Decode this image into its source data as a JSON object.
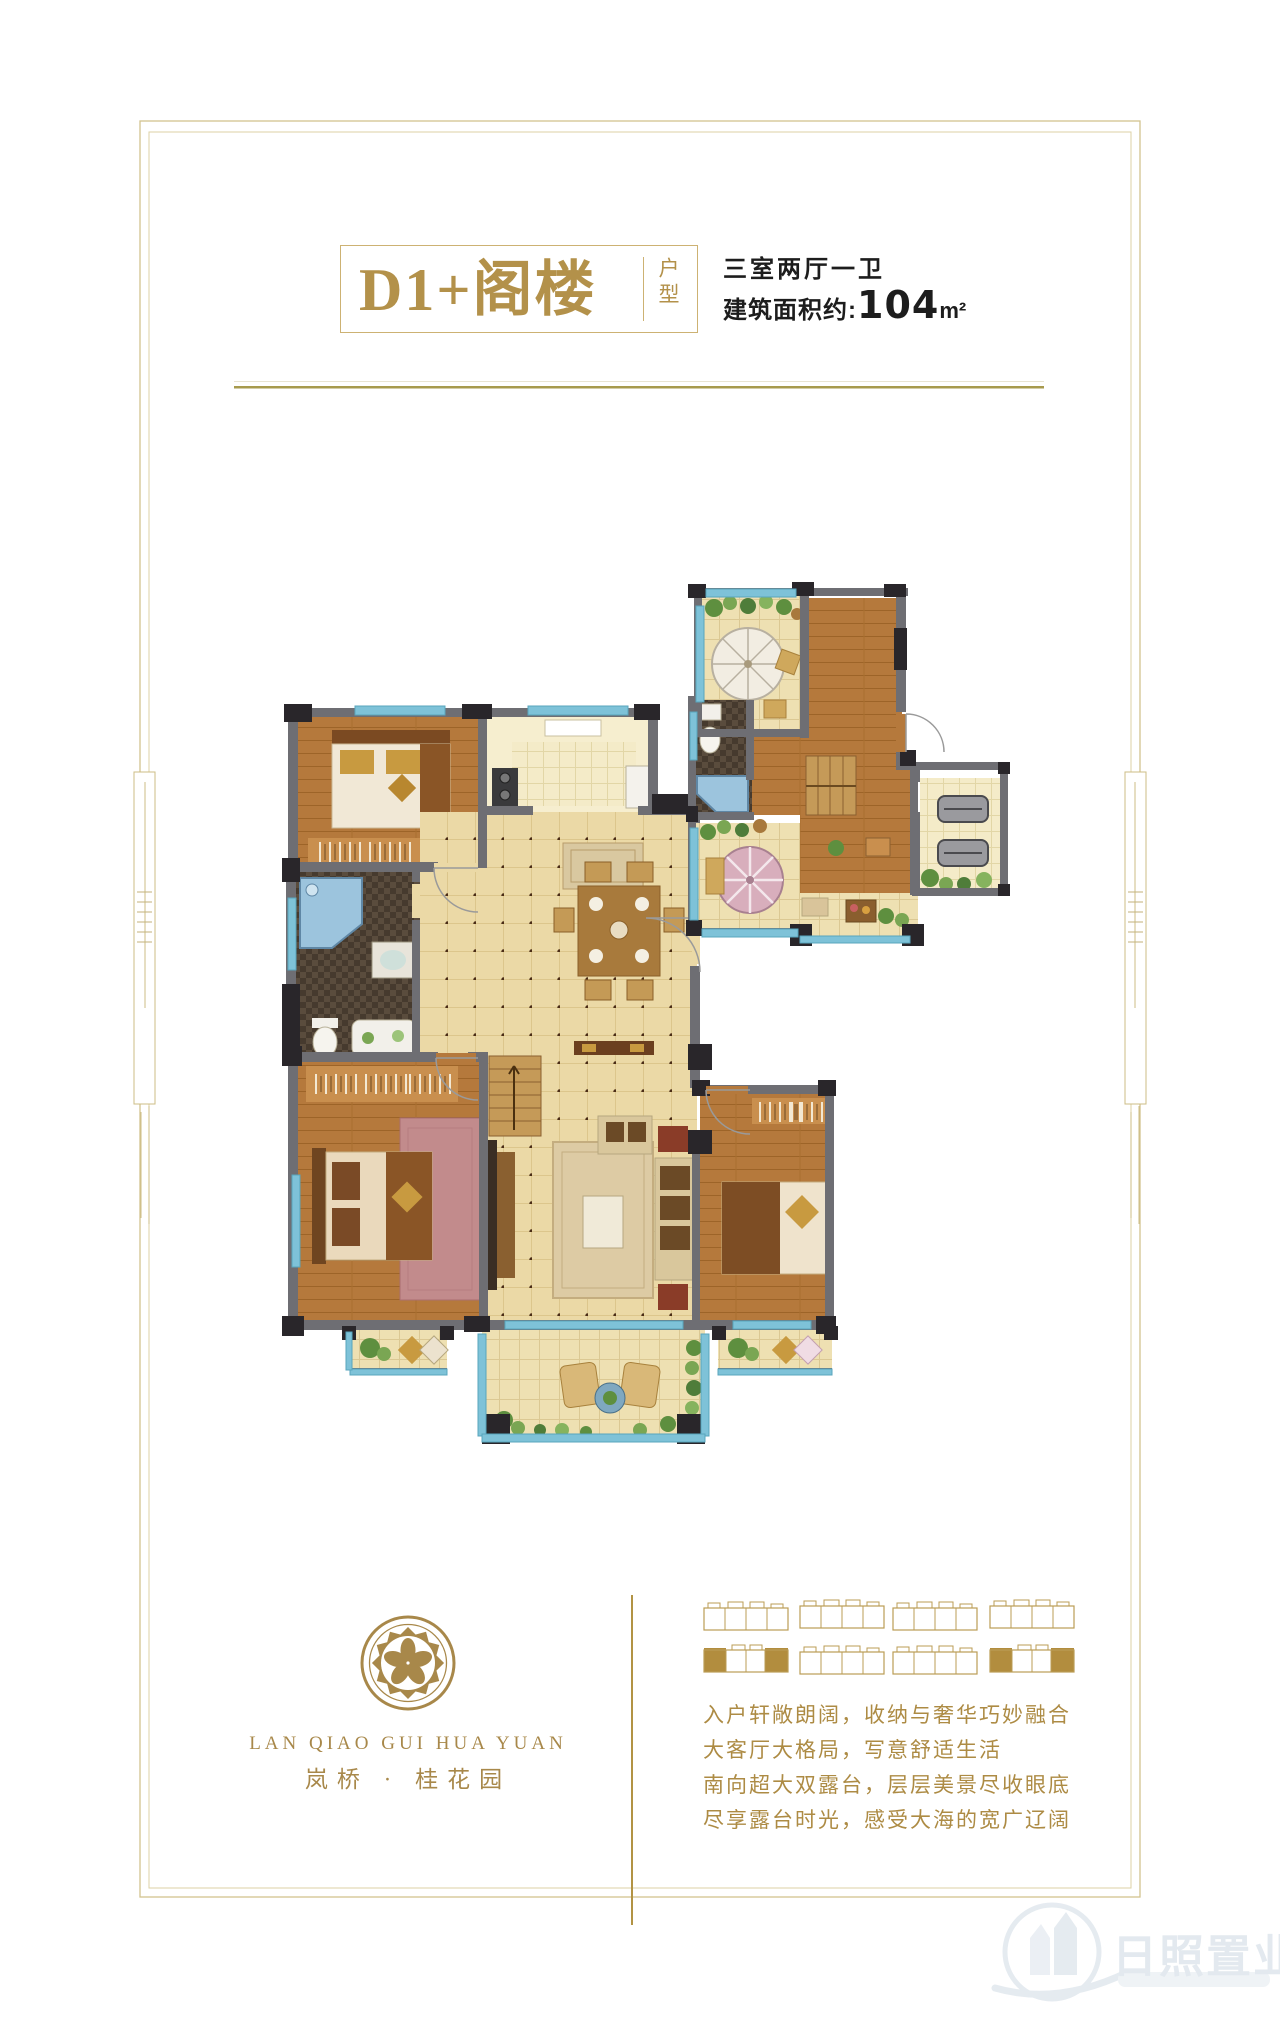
{
  "header": {
    "title": "D1+阁楼",
    "type_label": "户型",
    "layout_spec": "三室两厅一卫",
    "area_label": "建筑面积约:",
    "area_value": "104",
    "area_unit": "m²"
  },
  "brand": {
    "logo_icon": "plum-blossom-medallion-icon",
    "name_en": "LAN QIAO GUI HUA YUAN",
    "name_cn": "岚桥 · 桂花园"
  },
  "description": {
    "lines": [
      "入户轩敞朗阔，收纳与奢华巧妙融合",
      "大客厅大格局，写意舒适生活",
      "南向超大双露台，层层美景尽收眼底",
      "尽享露台时光，感受大海的宽广辽阔"
    ]
  },
  "siteplan": {
    "rows": 2,
    "buildings_per_row": 4,
    "highlighted_buildings": "row 2 — first and fourth building end units filled gold"
  },
  "watermark": {
    "name": "日照置业网",
    "logo_icon": "building-circle-icon"
  },
  "colors": {
    "gold": "#b3914a",
    "gold_light": "#cdb273",
    "frame": "#d2c48e",
    "divider_olive": "#a79a4d",
    "ink": "#1d1d1d",
    "wall_grey": "#6e6e73",
    "wall_black": "#29262a",
    "window_cyan": "#7ec2d8",
    "wood_floor": "#b5793c",
    "tile_cream": "#ebd9a6",
    "bath_mosaic": "#463a2e",
    "watermark_tint": "#e3e9ef"
  }
}
